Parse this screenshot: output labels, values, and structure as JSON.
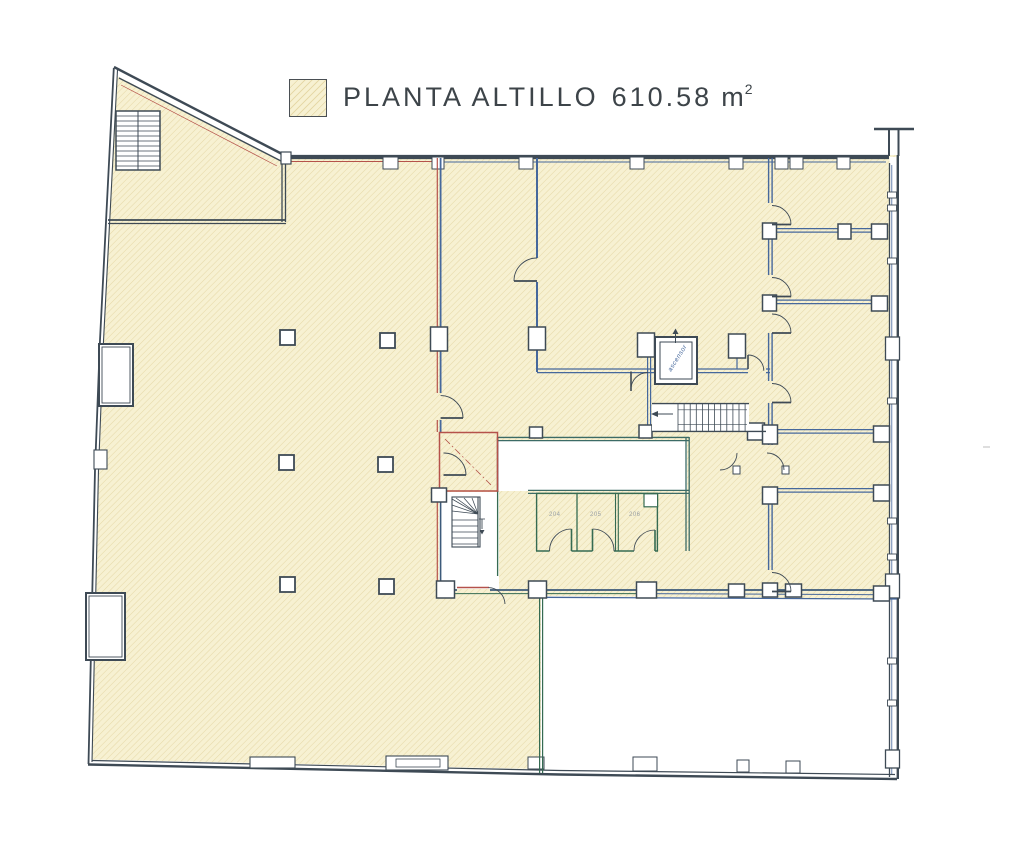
{
  "title": {
    "label": "PLANTA ALTILLO",
    "area_value": "610.58",
    "area_unit": "m",
    "area_exponent": "2"
  },
  "plan": {
    "elevator_label": "ascensor",
    "toilet_labels": [
      "204",
      "205",
      "206"
    ]
  },
  "colors": {
    "paper": "#ffffff",
    "hatch_fill": "#f7f1d2",
    "hatch_line": "#e6d9a8",
    "wall_dark": "#3e4a55",
    "wall_blue": "#46689c",
    "wall_green": "#356b52",
    "accent_red": "#b5524b",
    "title_text": "#3d4449"
  }
}
